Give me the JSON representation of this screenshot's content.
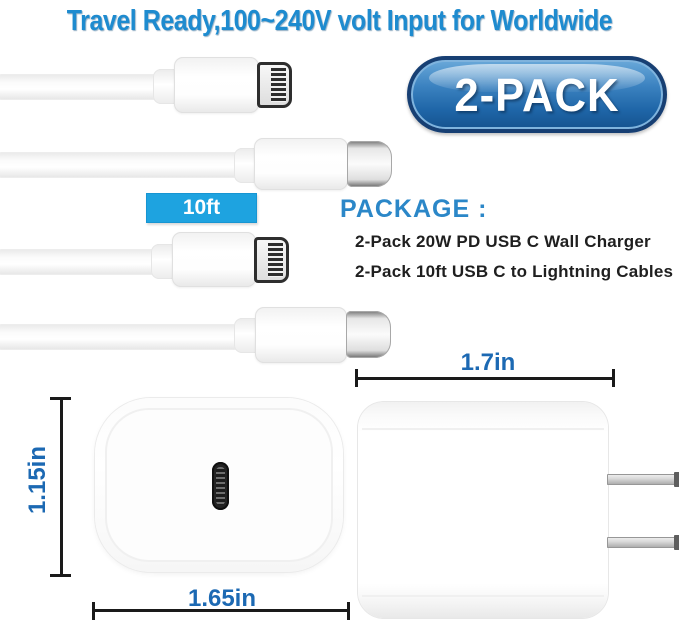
{
  "title": "Travel Ready,100~240V volt Input for Worldwide",
  "badge": {
    "label": "2-PACK"
  },
  "cables": {
    "length_label": "10ft"
  },
  "package": {
    "heading": "PACKAGE :",
    "items": [
      "2-Pack 20W PD USB C Wall Charger",
      "2-Pack 10ft USB C to Lightning Cables"
    ]
  },
  "dimensions": {
    "top_width": "1.7in",
    "side_height": "1.15in",
    "bottom_width": "1.65in"
  },
  "colors": {
    "title_blue": "#1e8bcf",
    "badge_border": "#173f73",
    "badge_blue_top": "#6aa9da",
    "badge_blue_bottom": "#15538f",
    "length_label_bg": "#1ea3e0",
    "package_heading_blue": "#2b87c8",
    "dimension_text_blue": "#1c69b3",
    "dimension_line": "#1a1a1a",
    "body_text": "#1f1f1f",
    "background": "#ffffff"
  }
}
